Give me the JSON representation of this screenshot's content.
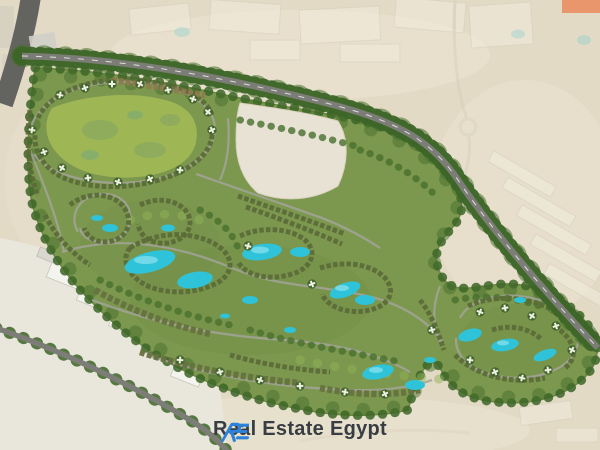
{
  "watermark": {
    "brand": "Real Estate Egypt",
    "monogram": "RE"
  },
  "colors": {
    "desert": "#e3dac5",
    "desert_light": "#ece5d4",
    "faded": "#f1ebdd",
    "faded_line": "#d7cfbc",
    "site_green": "#7c974e",
    "lawn": "#9fb655",
    "lawn_blotch": "#7fa463",
    "tree_dark": "#3c6527",
    "tree_mid": "#48702e",
    "tree_light": "#8fb457",
    "water": "#2fc3d9",
    "water_light": "#8fe3f0",
    "road_major": "#7d7d77",
    "road_dark": "#636360",
    "road_minor": "#a3a399",
    "building_row": "#5c6b39",
    "building_row_light": "#66713f",
    "commercial": "#8f7a50",
    "industrial_fill": "#f4f4ee",
    "villa_roof": "#eef0e2",
    "villa_base": "#3f6129",
    "logo_blue": "#2c82d9",
    "logo_text": "#383d44",
    "corner_accent": "#e9966d"
  }
}
